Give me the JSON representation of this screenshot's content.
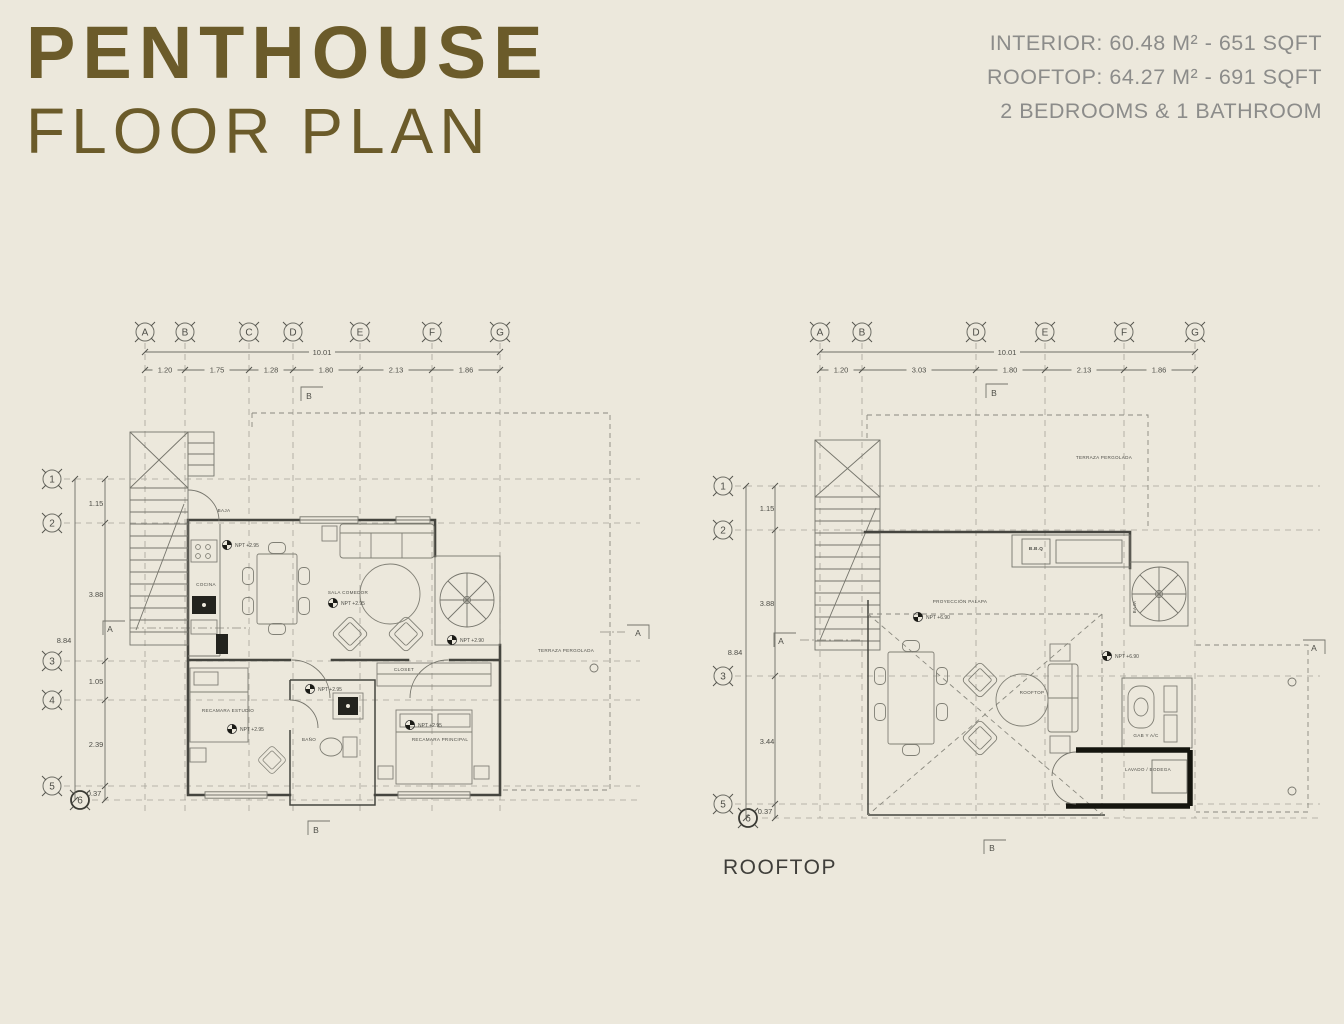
{
  "header": {
    "title_line1": "PENTHOUSE",
    "title_line2": "FLOOR PLAN"
  },
  "info": {
    "interior": "INTERIOR: 60.48 M²  - 651 SQFT",
    "rooftop": "ROOFTOP: 64.27 M² - 691 SQFT",
    "rooms": "2 BEDROOMS & 1 BATHROOM"
  },
  "colors": {
    "background": "#ECE8DC",
    "title": "#6B5B2A",
    "info_text": "#8C8C8A",
    "plan_line": "#6E6E66",
    "wall": "#45453F"
  },
  "plan_interior": {
    "grid_letters": [
      "A",
      "B",
      "C",
      "D",
      "E",
      "F",
      "G"
    ],
    "col_total": "10.01",
    "col_dims": [
      "1.20",
      "1.75",
      "1.28",
      "1.80",
      "2.13",
      "1.86"
    ],
    "row_numbers": [
      "1",
      "2",
      "3",
      "4",
      "5",
      "6"
    ],
    "row_total": "8.84",
    "row_dims": [
      "1.15",
      "3.88",
      "1.05",
      "2.39",
      "0.37"
    ],
    "section_markers": {
      "a": "A",
      "b": "B"
    },
    "labels": {
      "baja": "BAJA",
      "cocina": "COCINA",
      "sala_comedor": "SALA COMEDOR",
      "npt_kitchen": "NPT +2.95",
      "npt_living": "NPT +2.95",
      "npt_hall": "NPT +2.95",
      "npt_bedroom1": "NPT +2.95",
      "npt_bedroom2": "NPT +2.95",
      "npt_terrace": "NPT +2.90",
      "recamara_estudio": "RECAMARA ESTUDIO",
      "recamara_principal": "RECAMARA PRINCIPAL",
      "bano": "BAÑO",
      "closet": "CLOSET",
      "terraza": "TERRAZA PERGOLADA"
    }
  },
  "plan_rooftop": {
    "caption": "ROOFTOP",
    "grid_letters": [
      "A",
      "B",
      "D",
      "E",
      "F",
      "G"
    ],
    "col_total": "10.01",
    "col_dims": [
      "1.20",
      "3.03",
      "1.80",
      "2.13",
      "1.86"
    ],
    "row_numbers": [
      "1",
      "2",
      "3",
      "5",
      "6"
    ],
    "row_total": "8.84",
    "row_dims": [
      "1.15",
      "3.88",
      "3.44",
      "0.37"
    ],
    "section_markers": {
      "a": "A",
      "b": "B"
    },
    "labels": {
      "terraza_pergolada": "TERRAZA PERGOLADA",
      "proyeccion_palapa": "PROYECCIÓN PALAPA",
      "npt_deck": "NPT +6.90",
      "npt_side": "NPT +6.90",
      "rooftop_small": "ROOFTOP",
      "baja": "BAJA",
      "bbq": "B.B.Q",
      "gab_ac": "GAB Y A/C",
      "lavado_bodega": "LAVADO / BODEGA"
    }
  }
}
